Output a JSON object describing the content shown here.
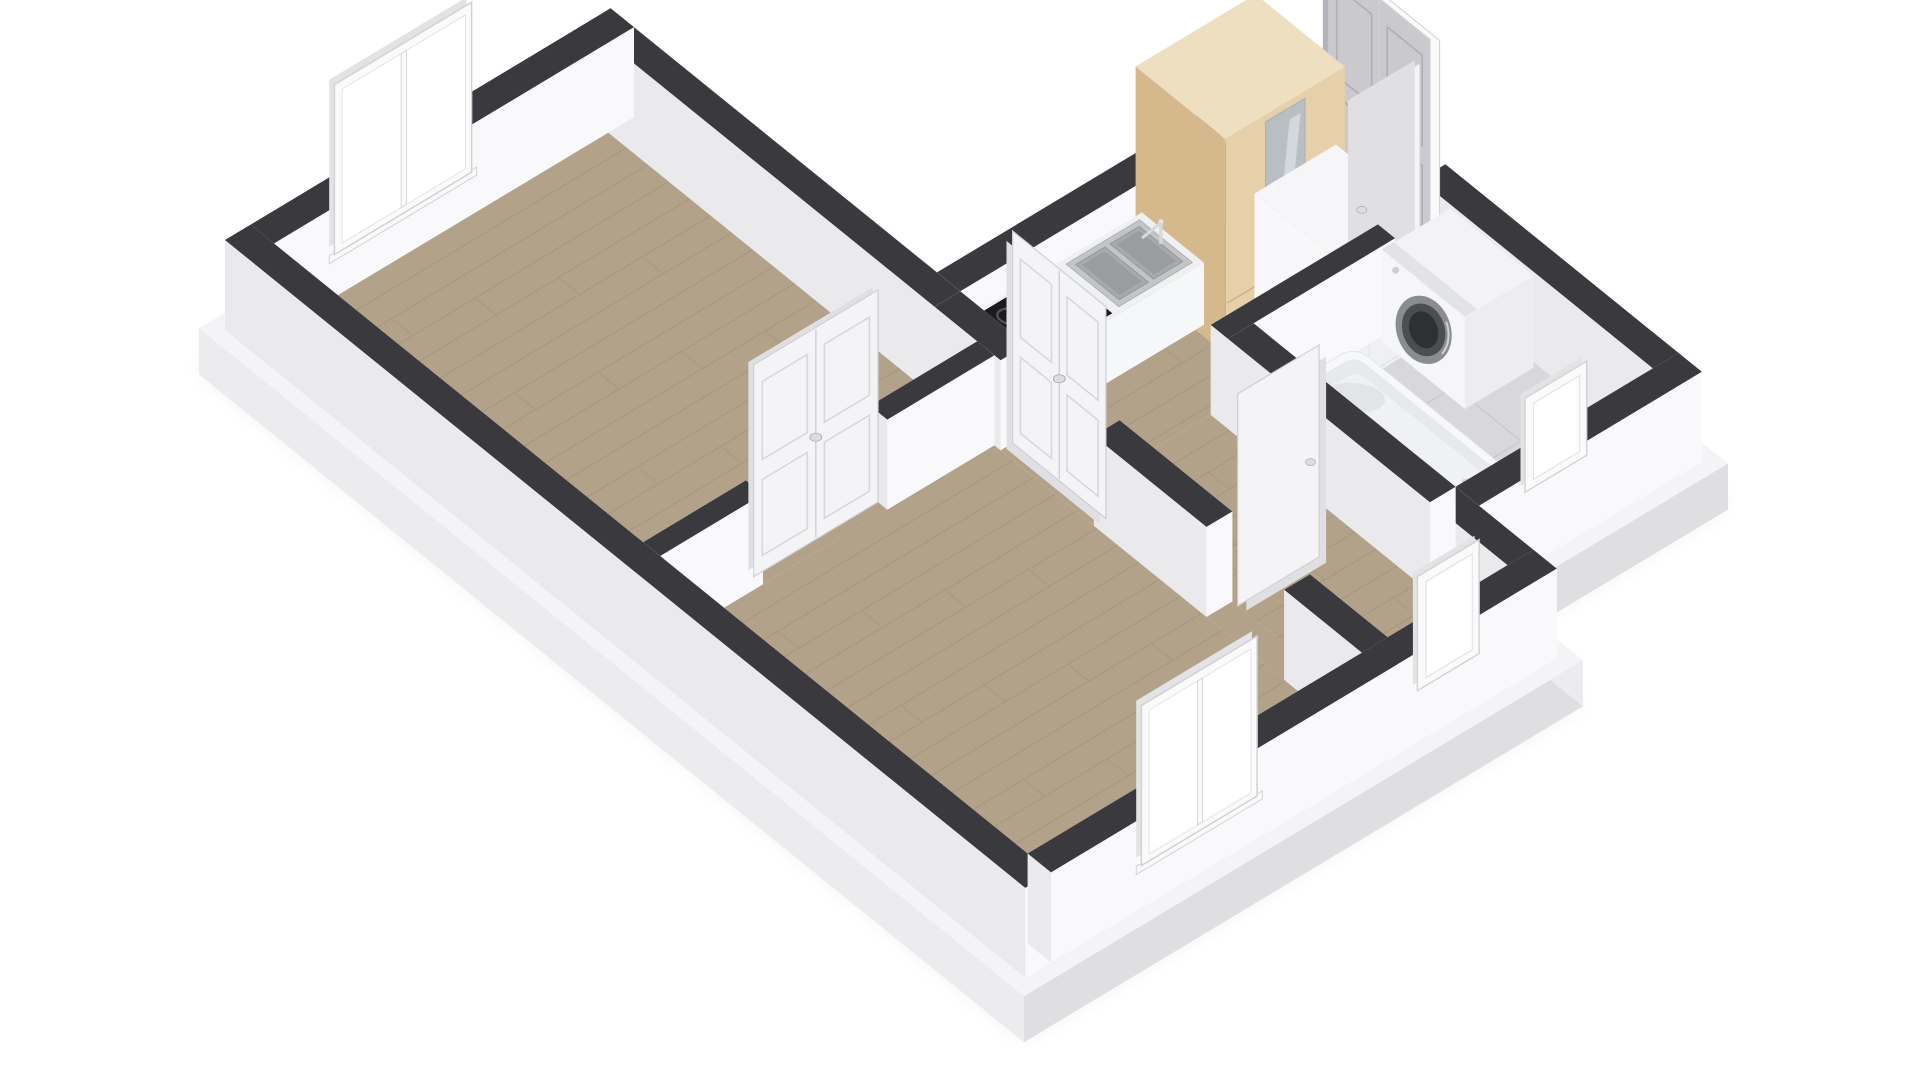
{
  "scene": {
    "description": "3d-dollhouse-floorplan",
    "background": "#ffffff",
    "palette": {
      "wall_top": "#3a3a3e",
      "wall_face_bright": "#f9f9fb",
      "wall_face_shade": "#eaeaed",
      "wall_face_dim": "#f1f1f3",
      "slab_face": "#ececee",
      "slab_face_shade": "#dfdfe2",
      "slab_top": "#f4f4f6",
      "wood_floor": "#b3a28a",
      "wood_seam": "#9c8c74",
      "tile_floor": "#d8d8dc",
      "tile_seam": "#c6c7cb",
      "door_white": "#f4f4f6",
      "door_white_shade": "#e0e0e4",
      "door_edge": "#cfcfd4",
      "door_gray": "#c9c9ce",
      "door_gray_shade": "#b3b3b9",
      "frame_white": "#fafafb",
      "frame_edge": "#d2d2d6",
      "glass": "#ffffff",
      "wardrobe_top": "#eedfc0",
      "wardrobe_front": "#e6d0a9",
      "wardrobe_side": "#d5b98c",
      "wardrobe_mirror": "#b7bfc3",
      "wardrobe_line": "#c9ad80",
      "cabinet_white": "#f2f2f4",
      "counter_top": "#eef0f1",
      "counter_face": "#f6f7f8",
      "counter_side": "#e3e4e7",
      "cooktop_black": "#1b1b1d",
      "cooktop_ring": "#515156",
      "sink_steel": "#c2c4c6",
      "sink_basin": "#a7a9ac",
      "washer_body": "#f3f3f5",
      "washer_face": "#ededf0",
      "washer_drum_outer": "#8a8d90",
      "washer_drum_mid": "#4b4e51",
      "washer_drum_dark": "#2e3033",
      "tub_rim": "#f7f8f9",
      "tub_inner": "#e8e9eb",
      "tub_floor": "#f0f1f3",
      "tub_shadow": "#d7d8db",
      "toilet_white": "#f5f5f7",
      "towel_purple": "#3f2040",
      "towel_purple_dark": "#30172f",
      "shadow": "#000000"
    },
    "rooms": [
      {
        "name": "bedroom",
        "floor": "wood"
      },
      {
        "name": "living-room",
        "floor": "wood"
      },
      {
        "name": "kitchen",
        "floor": "wood"
      },
      {
        "name": "hallway",
        "floor": "wood"
      },
      {
        "name": "bathroom",
        "floor": "tile"
      }
    ],
    "furniture": [
      "wardrobe",
      "tall-cabinet",
      "kitchen-counter",
      "washing-machine",
      "toilet",
      "bathtub"
    ],
    "openings": [
      "entrance-double-door",
      "bedroom-window",
      "bathroom-open-door",
      "hallway-open-door",
      "kitchen-double-door",
      "bedroom-double-door",
      "living-room-window",
      "bathroom-window",
      "hallway-wall-frame"
    ]
  }
}
